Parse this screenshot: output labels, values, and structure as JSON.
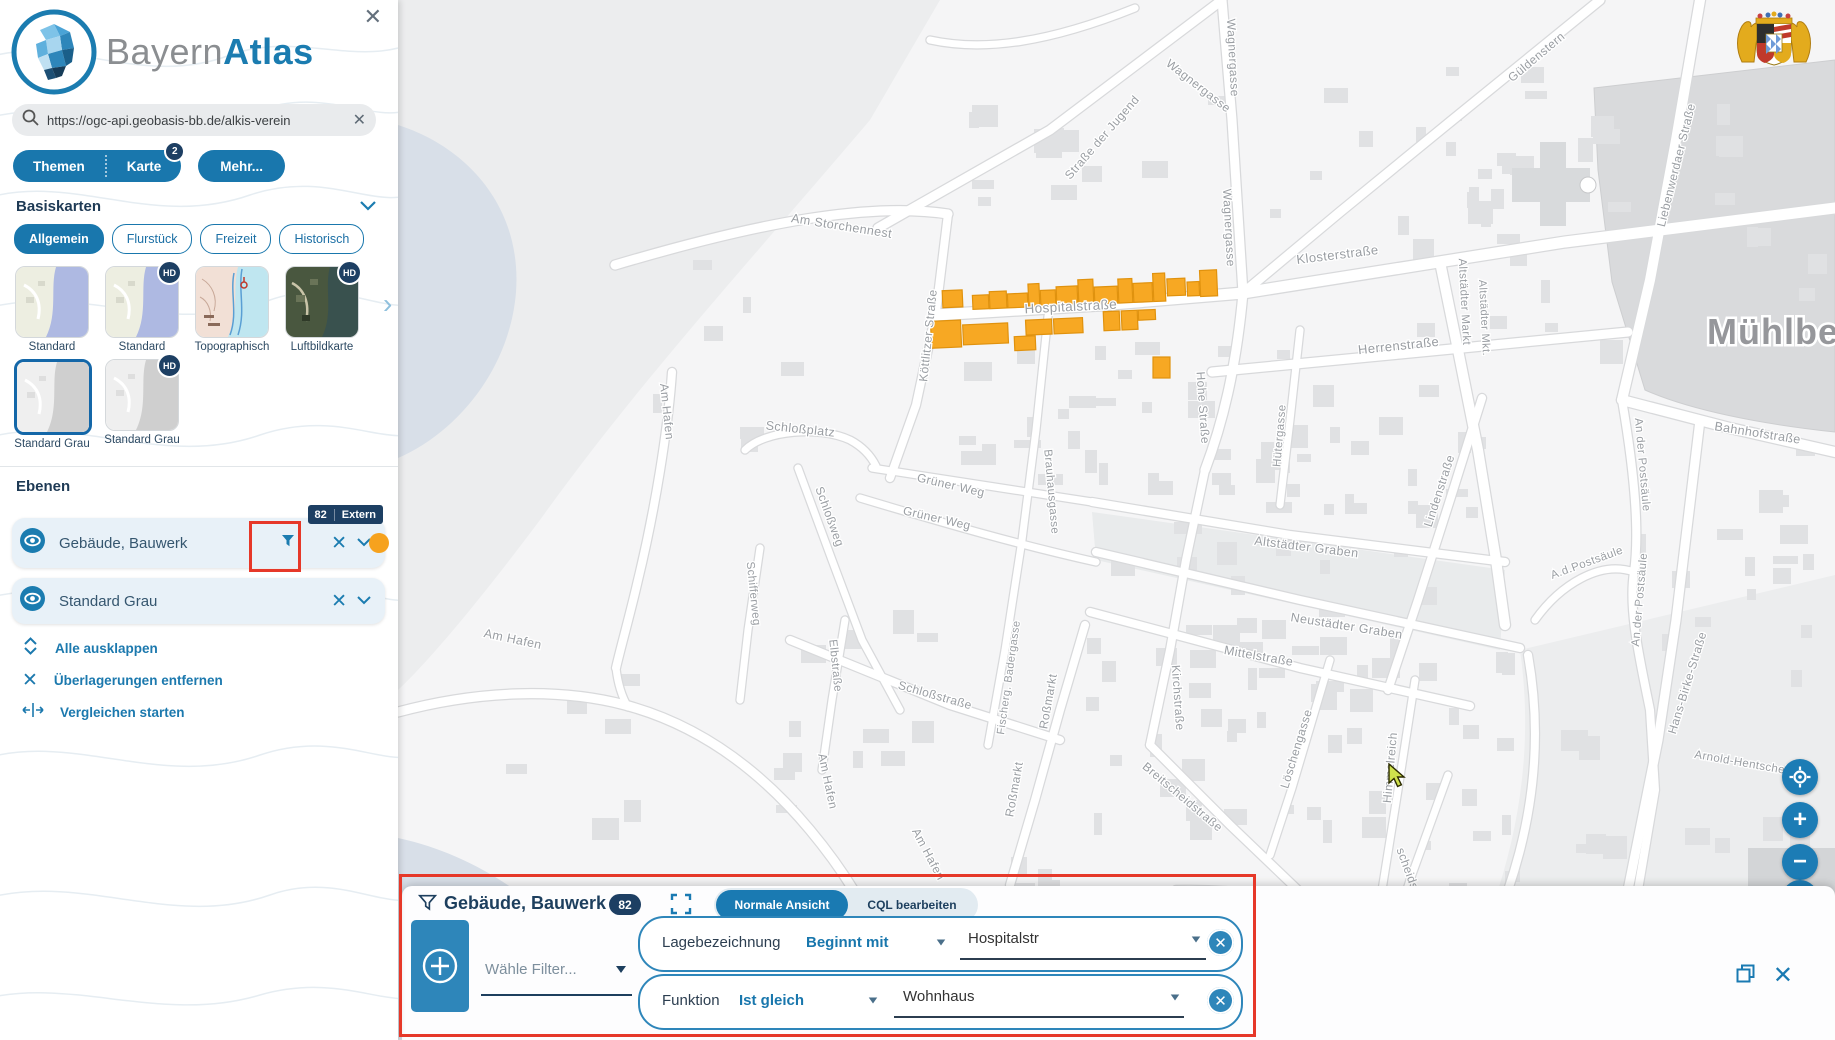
{
  "icons": {
    "close": "✕",
    "clear": "✕",
    "zoom_in": "+",
    "zoom_out": "−",
    "carousel_next": "›",
    "hd": "HD"
  },
  "sidebar": {
    "logo": {
      "gray": "Bayern",
      "blue": "Atlas"
    },
    "search": {
      "value": "https://ogc-api.geobasis-bb.de/alkis-verein"
    },
    "menu": {
      "themen": "Themen",
      "karte": "Karte",
      "karte_badge": "2",
      "mehr": "Mehr..."
    },
    "basiskarten": {
      "title": "Basiskarten",
      "chips": [
        {
          "label": "Allgemein",
          "active": true
        },
        {
          "label": "Flurstück",
          "active": false
        },
        {
          "label": "Freizeit",
          "active": false
        },
        {
          "label": "Historisch",
          "active": false
        }
      ],
      "thumbs": [
        {
          "label": "Standard",
          "hd": false,
          "selected": false
        },
        {
          "label": "Standard",
          "hd": true,
          "selected": false
        },
        {
          "label": "Topographisch",
          "hd": false,
          "selected": false
        },
        {
          "label": "Luftbildkarte",
          "hd": true,
          "selected": false
        },
        {
          "label": "Standard Grau",
          "hd": false,
          "selected": true
        },
        {
          "label": "Standard Grau",
          "hd": true,
          "selected": false
        }
      ]
    },
    "ebenen": {
      "title": "Ebenen",
      "layers": [
        {
          "name": "Gebäude, Bauwerk",
          "badge_count": "82",
          "badge_label": "Extern"
        },
        {
          "name": "Standard Grau"
        }
      ],
      "actions": [
        {
          "label": "Alle ausklappen"
        },
        {
          "label": "Überlagerungen entfernen"
        },
        {
          "label": "Vergleichen starten"
        }
      ]
    }
  },
  "filter_panel": {
    "title": "Gebäude, Bauwerk",
    "count": "82",
    "view_tabs": [
      {
        "label": "Normale Ansicht",
        "active": true
      },
      {
        "label": "CQL bearbeiten",
        "active": false
      }
    ],
    "filter_placeholder": "Wähle Filter...",
    "filters": [
      {
        "field": "Lagebezeichnung",
        "operator": "Beginnt mit",
        "value": "Hospitalstr"
      },
      {
        "field": "Funktion",
        "operator": "Ist gleich",
        "value": "Wohnhaus"
      }
    ]
  },
  "map": {
    "town_label": "Mühlberg",
    "highlight_color": "#f7a823",
    "highlight_stroke": "#e0920e",
    "street_labels": [
      {
        "t": "Wagnergasse",
        "x": 1229,
        "y": 58,
        "r": 87,
        "s": 12
      },
      {
        "t": "Wagnergasse",
        "x": 1196,
        "y": 89,
        "r": 38,
        "s": 12
      },
      {
        "t": "Wagnergasse",
        "x": 1225,
        "y": 228,
        "r": 87,
        "s": 12
      },
      {
        "t": "Straße der Jugend",
        "x": 1105,
        "y": 140,
        "r": -49,
        "s": 12
      },
      {
        "t": "Am Storchennest",
        "x": 841,
        "y": 230,
        "r": 9,
        "s": 12.5
      },
      {
        "t": "Güldenstern",
        "x": 1539,
        "y": 60,
        "r": -40,
        "s": 12
      },
      {
        "t": "Liebenwerdaer Straße",
        "x": 1680,
        "y": 166,
        "r": -76,
        "s": 12
      },
      {
        "t": "Klosterstraße",
        "x": 1338,
        "y": 259,
        "r": -7,
        "s": 13
      },
      {
        "t": "Herrenstraße",
        "x": 1399,
        "y": 350,
        "r": -6,
        "s": 13
      },
      {
        "t": "Altstädter Markt",
        "x": 1461,
        "y": 302,
        "r": 87,
        "s": 11.5
      },
      {
        "t": "Altstädter Mkt.",
        "x": 1481,
        "y": 318,
        "r": 87,
        "s": 11
      },
      {
        "t": "Hospitalstraße",
        "x": 1071,
        "y": 311,
        "r": -3,
        "s": 13.5
      },
      {
        "t": "Köttlitzer Straße",
        "x": 932,
        "y": 336,
        "r": -84,
        "s": 12
      },
      {
        "t": "Hohe Straße",
        "x": 1199,
        "y": 408,
        "r": 86,
        "s": 12
      },
      {
        "t": "Hütergasse",
        "x": 1283,
        "y": 436,
        "r": -85,
        "s": 11.5
      },
      {
        "t": "Lindenstraße",
        "x": 1443,
        "y": 492,
        "r": -72,
        "s": 12
      },
      {
        "t": "Schloßplatz",
        "x": 800,
        "y": 433,
        "r": 6,
        "s": 12.5
      },
      {
        "t": "Schloßweg",
        "x": 826,
        "y": 518,
        "r": 70,
        "s": 12
      },
      {
        "t": "Grüner Weg",
        "x": 950,
        "y": 489,
        "r": 13,
        "s": 12
      },
      {
        "t": "Grüner Weg",
        "x": 936,
        "y": 522,
        "r": 13,
        "s": 12
      },
      {
        "t": "Altstädter Graben",
        "x": 1306,
        "y": 551,
        "r": 7,
        "s": 12.5
      },
      {
        "t": "Neustädter Graben",
        "x": 1346,
        "y": 630,
        "r": 9,
        "s": 12.5
      },
      {
        "t": "Mittelstraße",
        "x": 1258,
        "y": 660,
        "r": 10,
        "s": 12.5
      },
      {
        "t": "Brauhausgasse",
        "x": 1048,
        "y": 492,
        "r": 85,
        "s": 11.5
      },
      {
        "t": "Fischerg. Badergasse",
        "x": 1012,
        "y": 678,
        "r": -82,
        "s": 11
      },
      {
        "t": "Kirchstraße",
        "x": 1174,
        "y": 698,
        "r": 86,
        "s": 12
      },
      {
        "t": "Roßmarkt",
        "x": 1052,
        "y": 702,
        "r": -80,
        "s": 12
      },
      {
        "t": "Roßmarkt",
        "x": 1018,
        "y": 790,
        "r": -80,
        "s": 12
      },
      {
        "t": "Schloßstraße",
        "x": 934,
        "y": 699,
        "r": 16,
        "s": 12
      },
      {
        "t": "Schifferweg",
        "x": 750,
        "y": 594,
        "r": 84,
        "s": 11.5
      },
      {
        "t": "Elbstraße",
        "x": 832,
        "y": 666,
        "r": 84,
        "s": 11.5
      },
      {
        "t": "Am Hafen",
        "x": 663,
        "y": 412,
        "r": 84,
        "s": 12
      },
      {
        "t": "Am Hafen",
        "x": 512,
        "y": 643,
        "r": 12,
        "s": 12.5
      },
      {
        "t": "Am Hafen",
        "x": 824,
        "y": 782,
        "r": 78,
        "s": 12
      },
      {
        "t": "Am Hafen",
        "x": 925,
        "y": 856,
        "r": 62,
        "s": 12
      },
      {
        "t": "Breitscheidstraße",
        "x": 1180,
        "y": 800,
        "r": 40,
        "s": 12
      },
      {
        "t": "Breitscheidstraße",
        "x": 1262,
        "y": 906,
        "r": 12,
        "s": 12
      },
      {
        "t": "Löschengasse",
        "x": 1300,
        "y": 750,
        "r": -73,
        "s": 12
      },
      {
        "t": "Himmelreich",
        "x": 1394,
        "y": 768,
        "r": -85,
        "s": 12
      },
      {
        "t": "scheidstraße",
        "x": 1409,
        "y": 884,
        "r": 70,
        "s": 12
      },
      {
        "t": "Bahnhofstraße",
        "x": 1757,
        "y": 437,
        "r": 9,
        "s": 12.5
      },
      {
        "t": "An der Postsäule",
        "x": 1639,
        "y": 465,
        "r": 85,
        "s": 11.5
      },
      {
        "t": "A.d.Postsäule",
        "x": 1588,
        "y": 566,
        "r": -20,
        "s": 11.5
      },
      {
        "t": "An der Postsäule",
        "x": 1643,
        "y": 600,
        "r": -85,
        "s": 11.5
      },
      {
        "t": "Hans-Birke-Straße",
        "x": 1691,
        "y": 684,
        "r": -73,
        "s": 12
      },
      {
        "t": "Arnold-Hentschel-Str.",
        "x": 1752,
        "y": 768,
        "r": 10,
        "s": 11.5
      }
    ],
    "highlighted_buildings": [
      {
        "x": 943,
        "y": 290,
        "w": 20,
        "h": 17
      },
      {
        "x": 973,
        "y": 296,
        "w": 16,
        "h": 14
      },
      {
        "x": 990,
        "y": 293,
        "w": 17,
        "h": 17
      },
      {
        "x": 1008,
        "y": 296,
        "w": 20,
        "h": 14
      },
      {
        "x": 1029,
        "y": 287,
        "w": 11,
        "h": 23
      },
      {
        "x": 1041,
        "y": 294,
        "w": 15,
        "h": 16
      },
      {
        "x": 1057,
        "y": 291,
        "w": 21,
        "h": 19
      },
      {
        "x": 1079,
        "y": 285,
        "w": 15,
        "h": 25
      },
      {
        "x": 1095,
        "y": 293,
        "w": 23,
        "h": 17
      },
      {
        "x": 1119,
        "y": 286,
        "w": 14,
        "h": 24
      },
      {
        "x": 1134,
        "y": 291,
        "w": 19,
        "h": 19
      },
      {
        "x": 1154,
        "y": 282,
        "w": 12,
        "h": 28
      },
      {
        "x": 1168,
        "y": 288,
        "w": 18,
        "h": 17
      },
      {
        "x": 1188,
        "y": 292,
        "w": 12,
        "h": 14
      },
      {
        "x": 1201,
        "y": 281,
        "w": 17,
        "h": 26
      },
      {
        "x": 930,
        "y": 320,
        "w": 30,
        "h": 27
      },
      {
        "x": 962,
        "y": 325,
        "w": 45,
        "h": 20
      },
      {
        "x": 1013,
        "y": 339,
        "w": 21,
        "h": 14
      },
      {
        "x": 1025,
        "y": 323,
        "w": 26,
        "h": 15
      },
      {
        "x": 1053,
        "y": 323,
        "w": 29,
        "h": 15
      },
      {
        "x": 1103,
        "y": 318,
        "w": 16,
        "h": 19
      },
      {
        "x": 1121,
        "y": 318,
        "w": 16,
        "h": 19
      },
      {
        "x": 1138,
        "y": 318,
        "w": 17,
        "h": 10
      },
      {
        "x": 1153,
        "y": 357,
        "w": 17,
        "h": 21,
        "solo": true
      }
    ]
  }
}
